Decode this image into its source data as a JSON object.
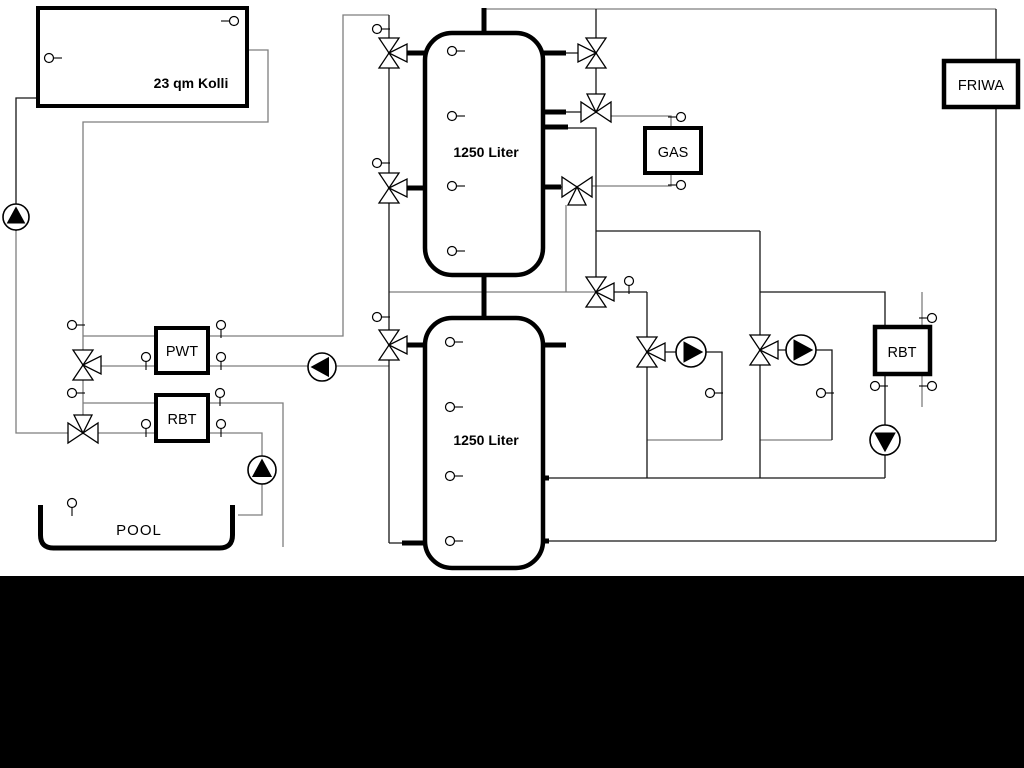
{
  "colors": {
    "background": "#ffffff",
    "pipe_black": "#161616",
    "pipe_gray": "#7e7e7e",
    "thick_stub": "#000000",
    "symbol_fill": "#ffffff",
    "footer_bar": "#000000"
  },
  "labels": {
    "collector": "23 qm Kolli",
    "tank_upper": "1250 Liter",
    "tank_lower": "1250 Liter",
    "pwt": "PWT",
    "rbt_pool": "RBT",
    "gas": "GAS",
    "friwa": "FRIWA",
    "rbt_right": "RBT",
    "pool": "POOL"
  },
  "pipes_gray": [
    [
      [
        247,
        50
      ],
      [
        268,
        50
      ],
      [
        268,
        122
      ],
      [
        83,
        122
      ],
      [
        83,
        433
      ]
    ],
    [
      [
        83,
        336
      ],
      [
        343,
        336
      ],
      [
        343,
        15
      ],
      [
        389,
        15
      ]
    ],
    [
      [
        83,
        366
      ],
      [
        389,
        366
      ]
    ],
    [
      [
        83,
        403
      ],
      [
        283,
        403
      ],
      [
        283,
        547
      ]
    ],
    [
      [
        83,
        433
      ],
      [
        262,
        433
      ],
      [
        262,
        515
      ],
      [
        238,
        515
      ]
    ],
    [
      [
        16,
        231
      ],
      [
        16,
        433
      ],
      [
        83,
        433
      ]
    ],
    [
      [
        389,
        292
      ],
      [
        596,
        292
      ]
    ],
    [
      [
        566,
        205
      ],
      [
        566,
        292
      ]
    ],
    [
      [
        611,
        116
      ],
      [
        671,
        116
      ],
      [
        671,
        130
      ]
    ],
    [
      [
        591,
        186
      ],
      [
        671,
        186
      ],
      [
        671,
        171
      ]
    ],
    [
      [
        647,
        440
      ],
      [
        722,
        440
      ]
    ],
    [
      [
        760,
        440
      ],
      [
        832,
        440
      ]
    ],
    [
      [
        922,
        292
      ],
      [
        922,
        407
      ]
    ],
    [
      [
        484,
        9
      ],
      [
        996,
        9
      ]
    ]
  ],
  "pipes_black": [
    [
      [
        38,
        98
      ],
      [
        16,
        98
      ],
      [
        16,
        231
      ]
    ],
    [
      [
        389,
        15
      ],
      [
        389,
        543
      ]
    ],
    [
      [
        596,
        9
      ],
      [
        596,
        96
      ]
    ],
    [
      [
        568,
        128
      ],
      [
        596,
        128
      ],
      [
        596,
        292
      ]
    ],
    [
      [
        596,
        231
      ],
      [
        760,
        231
      ]
    ],
    [
      [
        612,
        292
      ],
      [
        647,
        292
      ]
    ],
    [
      [
        647,
        292
      ],
      [
        647,
        478
      ]
    ],
    [
      [
        647,
        352
      ],
      [
        722,
        352
      ],
      [
        722,
        440
      ]
    ],
    [
      [
        760,
        231
      ],
      [
        760,
        478
      ]
    ],
    [
      [
        760,
        350
      ],
      [
        832,
        350
      ],
      [
        832,
        440
      ]
    ],
    [
      [
        760,
        292
      ],
      [
        885,
        292
      ],
      [
        885,
        478
      ]
    ],
    [
      [
        548,
        478
      ],
      [
        885,
        478
      ]
    ],
    [
      [
        548,
        541
      ],
      [
        996,
        541
      ]
    ],
    [
      [
        996,
        9
      ],
      [
        996,
        541
      ]
    ],
    [
      [
        543,
        53
      ],
      [
        580,
        53
      ]
    ],
    [
      [
        543,
        112
      ],
      [
        582,
        112
      ]
    ],
    [
      [
        543,
        187
      ],
      [
        577,
        187
      ]
    ],
    [
      [
        389,
        53
      ],
      [
        425,
        53
      ]
    ],
    [
      [
        389,
        188
      ],
      [
        425,
        188
      ]
    ],
    [
      [
        389,
        345
      ],
      [
        425,
        345
      ]
    ],
    [
      [
        389,
        543
      ],
      [
        425,
        543
      ]
    ]
  ],
  "stubs": [
    [
      [
        484,
        8
      ],
      [
        484,
        36
      ]
    ],
    [
      [
        484,
        273
      ],
      [
        484,
        320
      ]
    ],
    [
      [
        543,
        53
      ],
      [
        566,
        53
      ]
    ],
    [
      [
        543,
        112
      ],
      [
        566,
        112
      ]
    ],
    [
      [
        543,
        127
      ],
      [
        568,
        127
      ]
    ],
    [
      [
        543,
        187
      ],
      [
        561,
        187
      ]
    ],
    [
      [
        406,
        53
      ],
      [
        425,
        53
      ]
    ],
    [
      [
        406,
        188
      ],
      [
        425,
        188
      ]
    ],
    [
      [
        406,
        345
      ],
      [
        425,
        345
      ]
    ],
    [
      [
        402,
        543
      ],
      [
        425,
        543
      ]
    ],
    [
      [
        543,
        345
      ],
      [
        566,
        345
      ]
    ],
    [
      [
        543,
        478
      ],
      [
        549,
        478
      ]
    ],
    [
      [
        543,
        541
      ],
      [
        549,
        541
      ]
    ]
  ],
  "boxes": [
    {
      "name": "solar-collector",
      "key": "collector",
      "x": 38,
      "y": 8,
      "w": 209,
      "h": 98,
      "rx": 0,
      "sw": 4,
      "lx": 191,
      "ly": 88,
      "fs": 14,
      "bold": true
    },
    {
      "name": "buffer-tank-upper",
      "key": "tank_upper",
      "x": 425,
      "y": 33,
      "w": 118,
      "h": 242,
      "rx": 27,
      "sw": 4.5,
      "lx": 486,
      "ly": 157,
      "fs": 14,
      "bold": true
    },
    {
      "name": "buffer-tank-lower",
      "key": "tank_lower",
      "x": 425,
      "y": 318,
      "w": 118,
      "h": 250,
      "rx": 27,
      "sw": 4.5,
      "lx": 486,
      "ly": 445,
      "fs": 14,
      "bold": true
    },
    {
      "name": "pwt-heat-exchanger",
      "key": "pwt",
      "x": 156,
      "y": 328,
      "w": 52,
      "h": 45,
      "rx": 0,
      "sw": 4,
      "lx": 182,
      "ly": 356,
      "fs": 14.5,
      "bold": false
    },
    {
      "name": "rbt-pool-heat-exchanger",
      "key": "rbt_pool",
      "x": 156,
      "y": 395,
      "w": 52,
      "h": 46,
      "rx": 0,
      "sw": 4,
      "lx": 182,
      "ly": 424,
      "fs": 14.5,
      "bold": false
    },
    {
      "name": "gas-boiler",
      "key": "gas",
      "x": 645,
      "y": 128,
      "w": 56,
      "h": 45,
      "rx": 0,
      "sw": 4,
      "lx": 673,
      "ly": 157,
      "fs": 14.5,
      "bold": false
    },
    {
      "name": "friwa-station",
      "key": "friwa",
      "x": 944,
      "y": 61,
      "w": 74,
      "h": 46,
      "rx": 0,
      "sw": 4.5,
      "lx": 981,
      "ly": 90,
      "fs": 14.5,
      "bold": false
    },
    {
      "name": "rbt-right-heat-exchanger",
      "key": "rbt_right",
      "x": 875,
      "y": 327,
      "w": 55,
      "h": 47,
      "rx": 0,
      "sw": 4.5,
      "lx": 902,
      "ly": 357,
      "fs": 14.5,
      "bold": false
    }
  ],
  "pool": {
    "name": "pool-basin",
    "key": "pool",
    "path": "M 40.5,505 L 40.5,535 Q 40.5,548 53.5,548 L 219.5,548 Q 232.5,548 232.5,535 L 232.5,505",
    "sw": 5,
    "lx": 139,
    "ly": 535,
    "fs": 15,
    "ls": 1
  },
  "valves": [
    {
      "x": 389,
      "y": 53,
      "axis": "v",
      "third": "right"
    },
    {
      "x": 389,
      "y": 188,
      "axis": "v",
      "third": "right"
    },
    {
      "x": 389,
      "y": 345,
      "axis": "v",
      "third": "right"
    },
    {
      "x": 83,
      "y": 365,
      "axis": "v",
      "third": "right"
    },
    {
      "x": 83,
      "y": 433,
      "axis": "h",
      "third": "up"
    },
    {
      "x": 596,
      "y": 53,
      "axis": "v",
      "third": "left"
    },
    {
      "x": 596,
      "y": 112,
      "axis": "h",
      "third": "up"
    },
    {
      "x": 577,
      "y": 187,
      "axis": "h",
      "third": "down"
    },
    {
      "x": 596,
      "y": 292,
      "axis": "v",
      "third": "right"
    },
    {
      "x": 647,
      "y": 352,
      "axis": "v",
      "third": "right"
    },
    {
      "x": 760,
      "y": 350,
      "axis": "v",
      "third": "right"
    }
  ],
  "pumps": [
    {
      "x": 16,
      "y": 217,
      "r": 13,
      "dir": "up"
    },
    {
      "x": 322,
      "y": 367,
      "r": 14,
      "dir": "left"
    },
    {
      "x": 262,
      "y": 470,
      "r": 14,
      "dir": "up"
    },
    {
      "x": 691,
      "y": 352,
      "r": 15,
      "dir": "right"
    },
    {
      "x": 801,
      "y": 350,
      "r": 15,
      "dir": "right"
    },
    {
      "x": 885,
      "y": 440,
      "r": 15,
      "dir": "down"
    }
  ],
  "sensors": [
    {
      "x": 234,
      "y": 21,
      "stem": "left"
    },
    {
      "x": 49,
      "y": 58,
      "stem": "right"
    },
    {
      "x": 377,
      "y": 29,
      "stem": "right"
    },
    {
      "x": 377,
      "y": 163,
      "stem": "right"
    },
    {
      "x": 377,
      "y": 317,
      "stem": "right"
    },
    {
      "x": 72,
      "y": 325,
      "stem": "right"
    },
    {
      "x": 72,
      "y": 393,
      "stem": "right"
    },
    {
      "x": 146,
      "y": 357,
      "stem": "down"
    },
    {
      "x": 221,
      "y": 357,
      "stem": "down"
    },
    {
      "x": 221,
      "y": 325,
      "stem": "down"
    },
    {
      "x": 146,
      "y": 424,
      "stem": "down"
    },
    {
      "x": 221,
      "y": 424,
      "stem": "down"
    },
    {
      "x": 220,
      "y": 393,
      "stem": "down"
    },
    {
      "x": 72,
      "y": 503,
      "stem": "down"
    },
    {
      "x": 452,
      "y": 51,
      "stem": "right"
    },
    {
      "x": 452,
      "y": 116,
      "stem": "right"
    },
    {
      "x": 452,
      "y": 186,
      "stem": "right"
    },
    {
      "x": 452,
      "y": 251,
      "stem": "right"
    },
    {
      "x": 450,
      "y": 342,
      "stem": "right"
    },
    {
      "x": 450,
      "y": 407,
      "stem": "right"
    },
    {
      "x": 450,
      "y": 476,
      "stem": "right"
    },
    {
      "x": 450,
      "y": 541,
      "stem": "right"
    },
    {
      "x": 629,
      "y": 281,
      "stem": "down"
    },
    {
      "x": 710,
      "y": 393,
      "stem": "right"
    },
    {
      "x": 821,
      "y": 393,
      "stem": "right"
    },
    {
      "x": 875,
      "y": 386,
      "stem": "right"
    },
    {
      "x": 932,
      "y": 318,
      "stem": "left"
    },
    {
      "x": 932,
      "y": 386,
      "stem": "left"
    },
    {
      "x": 681,
      "y": 117,
      "stem": "left"
    },
    {
      "x": 681,
      "y": 185,
      "stem": "left"
    }
  ],
  "footer": {
    "y": 576,
    "height": 192
  }
}
